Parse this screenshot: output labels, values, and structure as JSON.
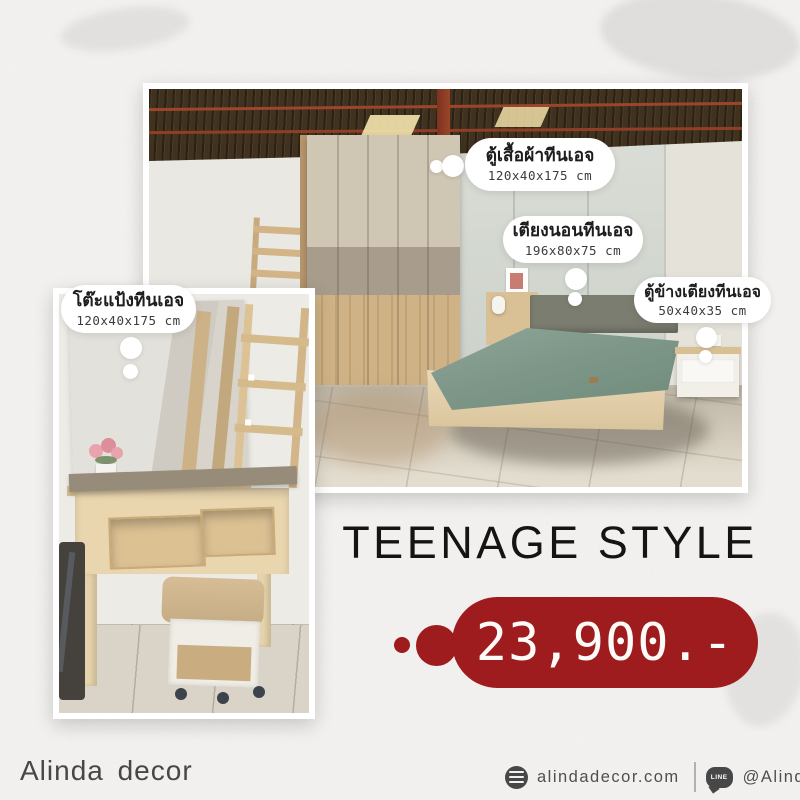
{
  "poster": {
    "title": "TEENAGE STYLE",
    "price": "23,900.-",
    "accent_color": "#9e1b1e",
    "background_color": "#f4f3f1"
  },
  "callouts": [
    {
      "name": "wardrobe",
      "title": "ตู้เสื้อผ้าทีนเอจ",
      "dimensions": "120x40x175 cm"
    },
    {
      "name": "bed",
      "title": "เตียงนอนทีนเอจ",
      "dimensions": "196x80x75 cm"
    },
    {
      "name": "bedside-cabinet",
      "title": "ตู้ข้างเตียงทีนเอจ",
      "dimensions": "50x40x35 cm"
    },
    {
      "name": "dressing-table",
      "title": "โต๊ะแป้งทีนเอจ",
      "dimensions": "120x40x175 cm"
    }
  ],
  "footer": {
    "brand": "Alinda decor",
    "website": "alindadecor.com",
    "line_id": "@Alindadecor",
    "line_icon_text": "LINE"
  },
  "scene_colors": {
    "roof_brown": "#41321f",
    "truss_red": "#9c452a",
    "wardrobe_wood": "#cfb386",
    "wardrobe_taupe": "#a89d8d",
    "mattress_sage": "#7e9789",
    "floor_beige": "#d8d1c1"
  }
}
